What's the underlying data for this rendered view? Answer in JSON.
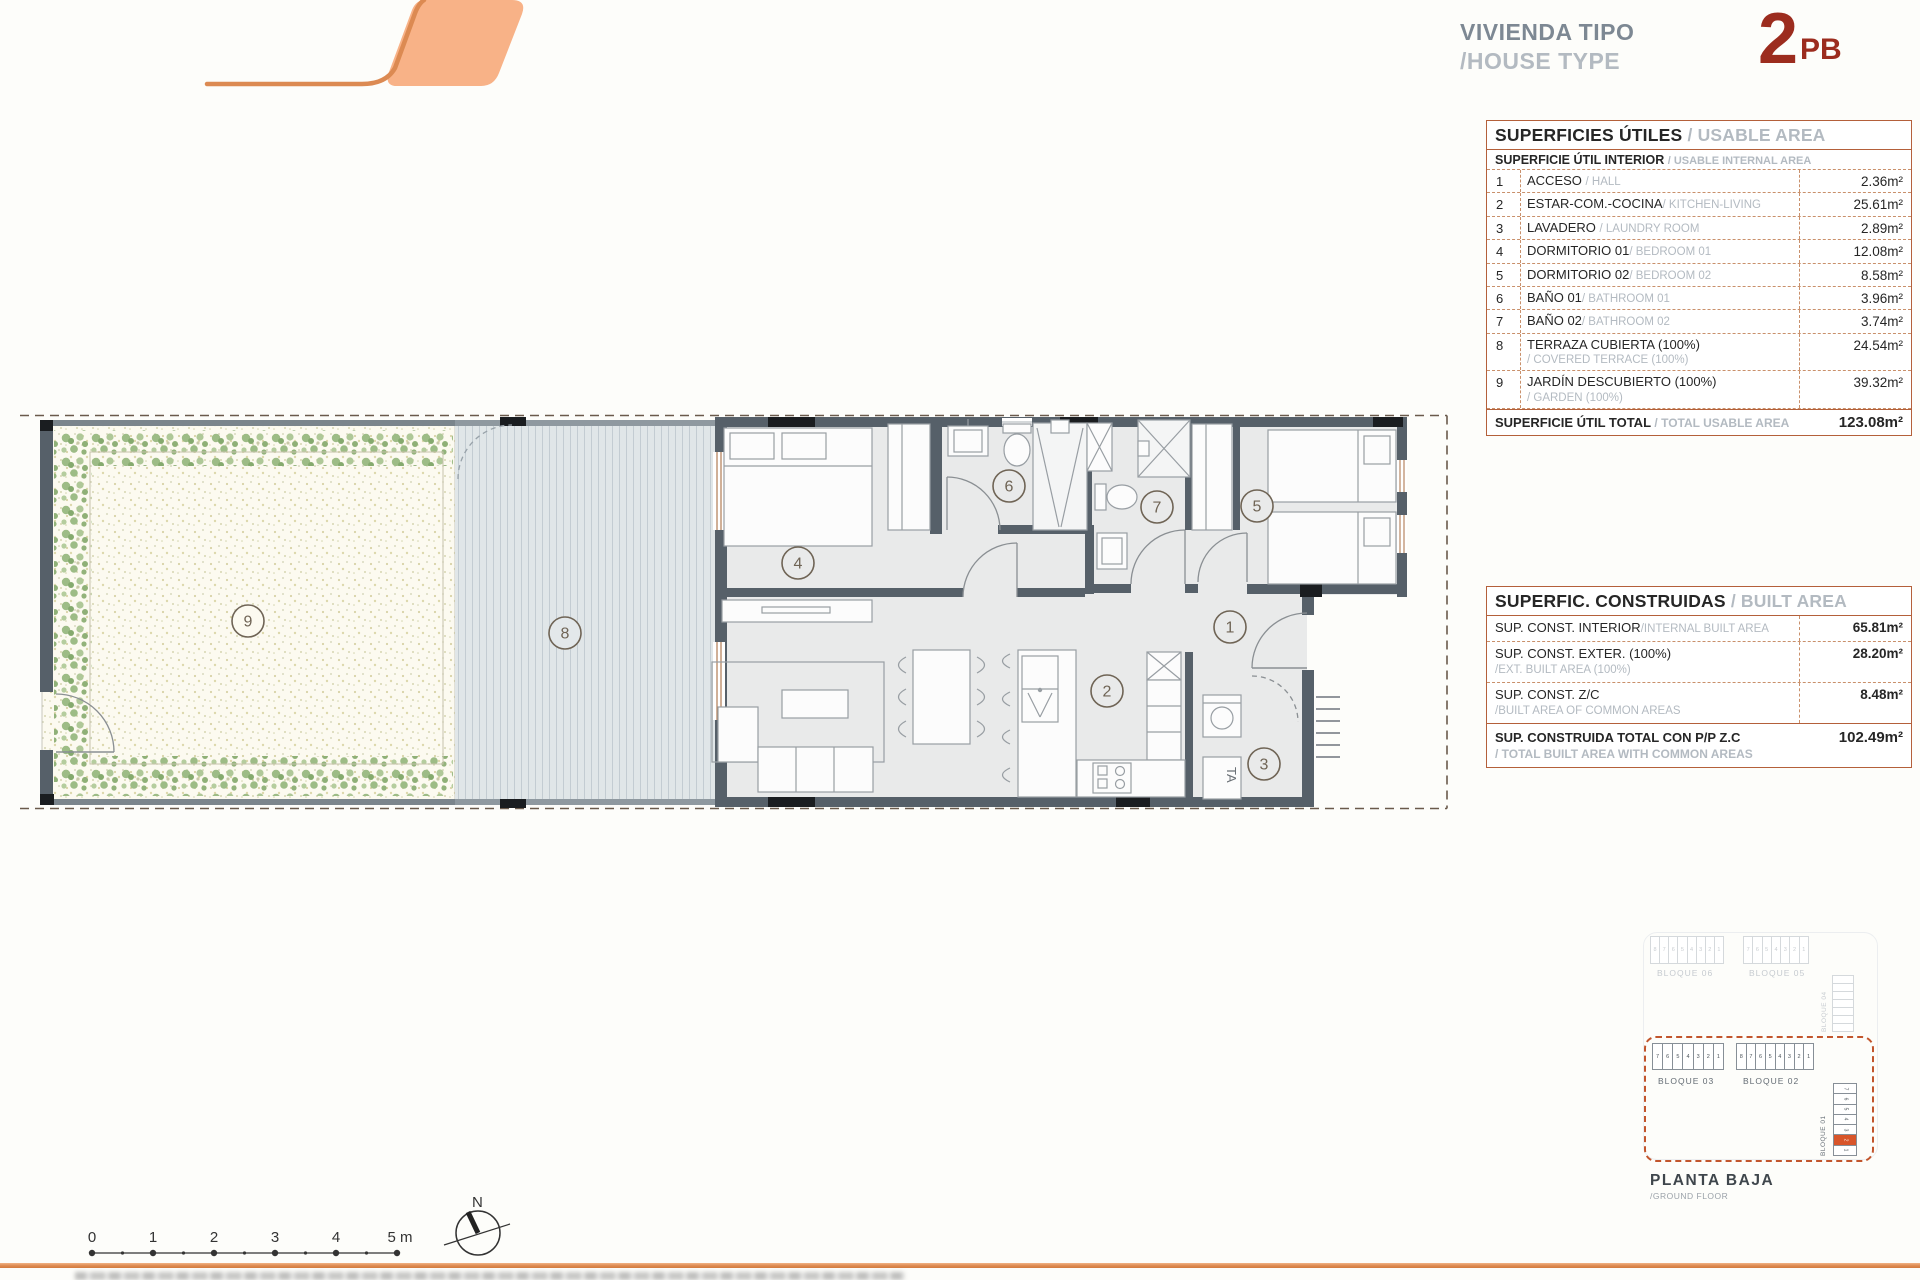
{
  "header": {
    "title_es": "VIVIENDA TIPO",
    "title_en": "/HOUSE TYPE",
    "type_number": "2",
    "type_suffix": "PB"
  },
  "usable_table": {
    "title_es": "SUPERFICIES ÚTILES",
    "title_en": "/ USABLE AREA",
    "subtitle_es": "SUPERFICIE ÚTIL INTERIOR",
    "subtitle_en": "/ USABLE INTERNAL AREA",
    "rows": [
      {
        "num": "1",
        "es": "ACCESO",
        "en": "/ HALL",
        "area": "2.36m²"
      },
      {
        "num": "2",
        "es": "ESTAR-COM.-COCINA",
        "en": "/ KITCHEN-LIVING",
        "area": "25.61m²"
      },
      {
        "num": "3",
        "es": "LAVADERO",
        "en": "/ LAUNDRY ROOM",
        "area": "2.89m²"
      },
      {
        "num": "4",
        "es": "DORMITORIO 01",
        "en": "/ BEDROOM 01",
        "area": "12.08m²"
      },
      {
        "num": "5",
        "es": "DORMITORIO 02",
        "en": "/ BEDROOM 02",
        "area": "8.58m²"
      },
      {
        "num": "6",
        "es": "BAÑO 01",
        "en": "/ BATHROOM 01",
        "area": "3.96m²"
      },
      {
        "num": "7",
        "es": "BAÑO 02",
        "en": "/ BATHROOM 02",
        "area": "3.74m²"
      },
      {
        "num": "8",
        "es": "TERRAZA CUBIERTA (100%)",
        "en": "/ COVERED TERRACE (100%)",
        "area": "24.54m²"
      },
      {
        "num": "9",
        "es": "JARDÍN DESCUBIERTO (100%)",
        "en": "/ GARDEN (100%)",
        "area": "39.32m²"
      }
    ],
    "total_es": "SUPERFICIE ÚTIL TOTAL",
    "total_en": "/ TOTAL USABLE AREA",
    "total_area": "123.08m²"
  },
  "built_table": {
    "title_es": "SUPERFIC. CONSTRUIDAS",
    "title_en": "/ BUILT AREA",
    "rows": [
      {
        "es": "SUP. CONST. INTERIOR",
        "en": "/INTERNAL BUILT AREA",
        "area": "65.81m²"
      },
      {
        "es": "SUP. CONST. EXTER. (100%)",
        "en": "/EXT. BUILT AREA (100%)",
        "area": "28.20m²"
      },
      {
        "es": "SUP. CONST. Z/C",
        "en": "/BUILT AREA OF COMMON AREAS",
        "area": "8.48m²"
      }
    ],
    "total_es": "SUP. CONSTRUIDA TOTAL CON P/P Z.C",
    "total_en": "/ TOTAL BUILT AREA WITH COMMON AREAS",
    "total_area": "102.49m²"
  },
  "plan": {
    "room_labels": [
      "1",
      "2",
      "3",
      "4",
      "5",
      "6",
      "7",
      "8",
      "9"
    ],
    "appliance_label": "TA"
  },
  "site": {
    "block06": {
      "label": "BLOQUE 06",
      "units": [
        "8",
        "7",
        "6",
        "5",
        "4",
        "3",
        "2",
        "1"
      ]
    },
    "block05": {
      "label": "BLOQUE 05",
      "units": [
        "7",
        "6",
        "5",
        "4",
        "3",
        "2",
        "1"
      ]
    },
    "block04": {
      "label": "BLOQUE 04",
      "units": [
        "",
        "",
        "",
        "",
        "",
        "",
        ""
      ]
    },
    "block03": {
      "label": "BLOQUE 03",
      "units": [
        "7",
        "6",
        "5",
        "4",
        "3",
        "2",
        "1"
      ]
    },
    "block02": {
      "label": "BLOQUE 02",
      "units": [
        "8",
        "7",
        "6",
        "5",
        "4",
        "3",
        "2",
        "1"
      ]
    },
    "block01": {
      "label": "BLOQUE 01",
      "units": [
        "7",
        "6",
        "5",
        "4",
        "3",
        "2",
        "1"
      ],
      "highlight_index": 5
    },
    "floor_label_es": "PLANTA BAJA",
    "floor_label_en": "/GROUND FLOOR"
  },
  "scalebar": {
    "labels": [
      "0",
      "1",
      "2",
      "3",
      "4",
      "5 m"
    ]
  },
  "compass": {
    "north_label": "N"
  },
  "colors": {
    "accent_orange": "#DD8A50",
    "logo_fill": "#F8B287",
    "type_red": "#9C2C1E",
    "table_border": "#B4603A",
    "wall": "#566069",
    "highlight_unit": "#D8552A"
  }
}
